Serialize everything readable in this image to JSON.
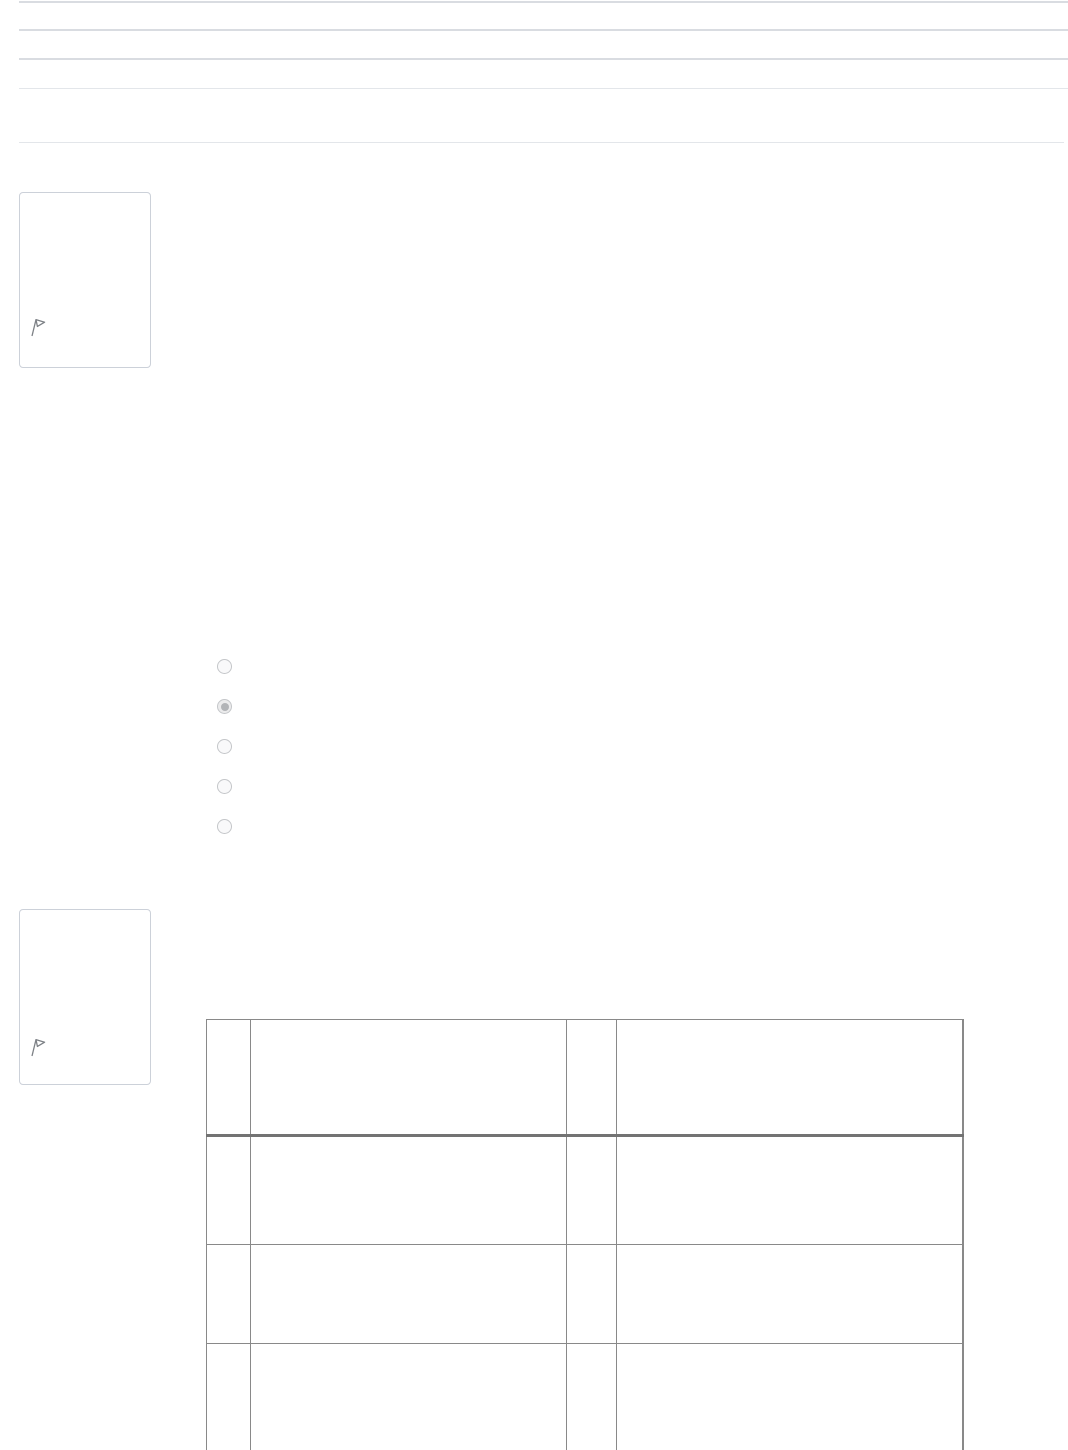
{
  "header": {
    "divider_count": 5
  },
  "question_1": {
    "flag_icon": "flag-icon",
    "answer_options": [
      "",
      "",
      "",
      "",
      ""
    ],
    "selected_option_index": 1
  },
  "question_2": {
    "flag_icon": "flag-icon",
    "answer_table": {
      "rows": [
        [
          "",
          "",
          "",
          ""
        ],
        [
          "",
          "",
          "",
          ""
        ],
        [
          "",
          "",
          "",
          ""
        ],
        [
          "",
          "",
          "",
          ""
        ]
      ]
    }
  },
  "colors": {
    "divider_strong": "#d9dce1",
    "divider_light": "#e3e6ea",
    "box_border": "#ccd1d9",
    "flag_icon": "#7d8186",
    "radio_border": "#c4c6c9",
    "radio_selected_dot": "#b2b4b7",
    "table_border": "#898989",
    "table_header_border": "#737373"
  }
}
